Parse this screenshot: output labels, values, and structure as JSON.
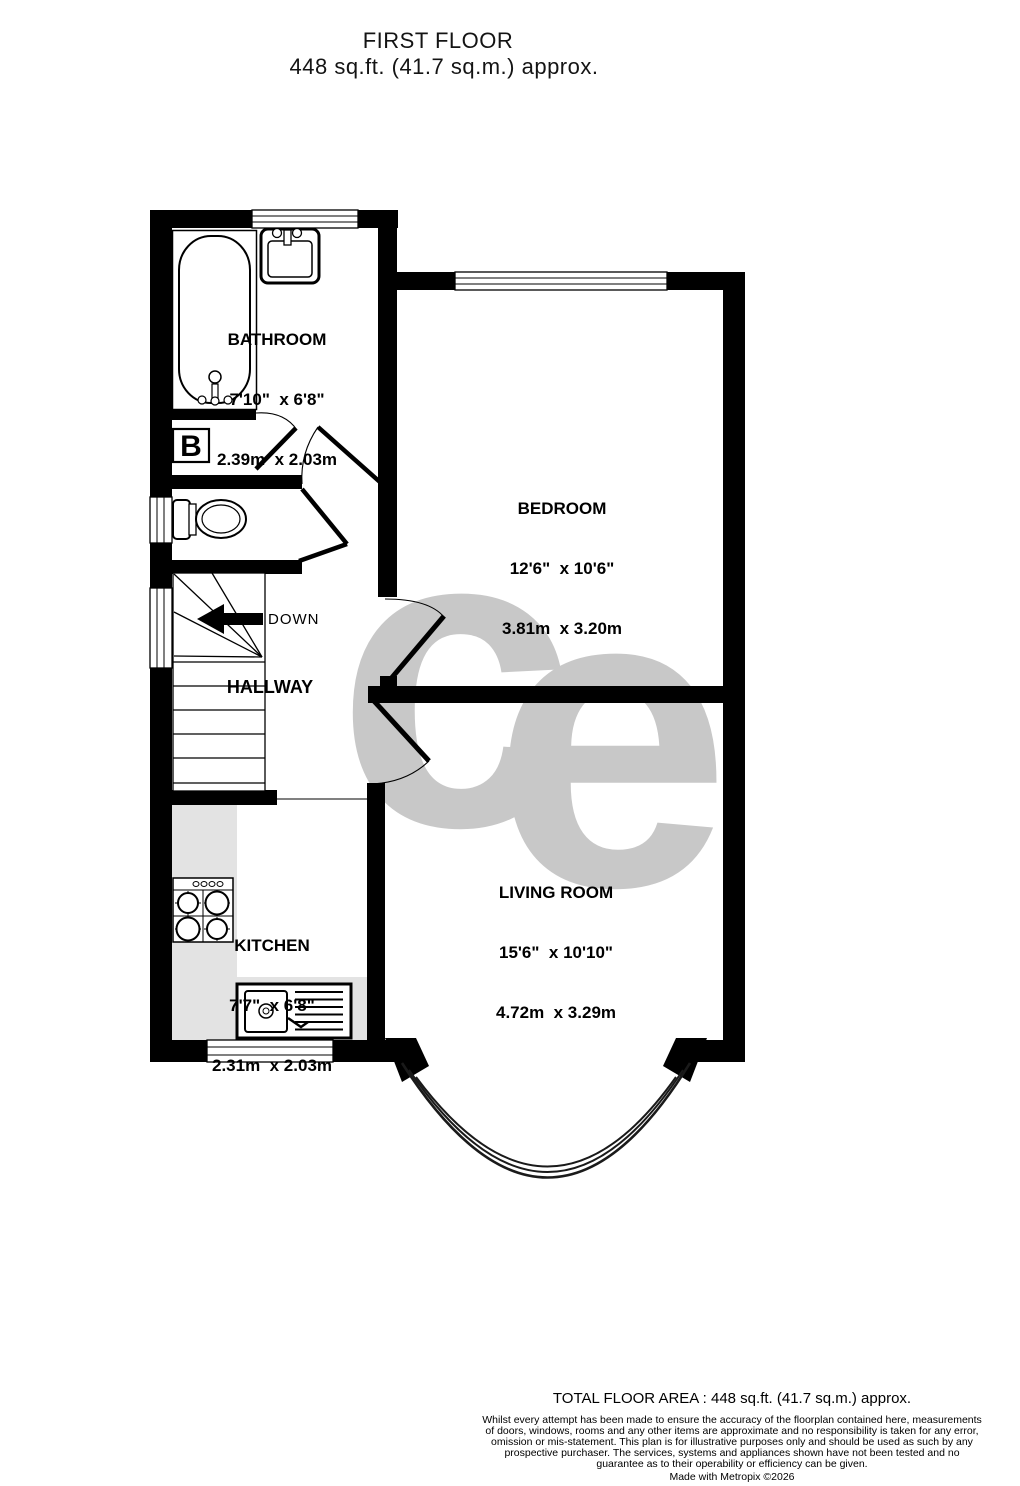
{
  "title": {
    "line1": "FIRST FLOOR",
    "line2": "448 sq.ft. (41.7 sq.m.) approx."
  },
  "rooms": [
    {
      "name": "BATHROOM",
      "imperial": "7'10\"  x 6'8\"",
      "metric": "2.39m  x 2.03m"
    },
    {
      "name": "BEDROOM",
      "imperial": "12'6\"  x 10'6\"",
      "metric": "3.81m  x 3.20m"
    },
    {
      "name": "HALLWAY"
    },
    {
      "name": "KITCHEN",
      "imperial": "7'7\"  x 6'8\"",
      "metric": "2.31m  x 2.03m"
    },
    {
      "name": "LIVING ROOM",
      "imperial": "15'6\"  x 10'10\"",
      "metric": "4.72m  x 3.29m"
    }
  ],
  "labels": {
    "down": "DOWN",
    "boiler": "B",
    "watermark_c": "c",
    "watermark_e": "e"
  },
  "footer": {
    "total": "TOTAL FLOOR AREA : 448 sq.ft. (41.7 sq.m.) approx.",
    "disclaimer": "Whilst every attempt has been made to ensure the accuracy of the floorplan contained here, measurements of doors, windows, rooms and any other items are approximate and no responsibility is taken for any error, omission or mis-statement. This plan is for illustrative purposes only and should be used as such by any prospective purchaser. The services, systems and appliances shown have not been tested and no guarantee as to their operability or efficiency can be given.",
    "credit": "Made with Metropix ©2026"
  },
  "colors": {
    "wall": "#000000",
    "counter": "#e3e3e3",
    "watermark": "#c8c8c8"
  }
}
